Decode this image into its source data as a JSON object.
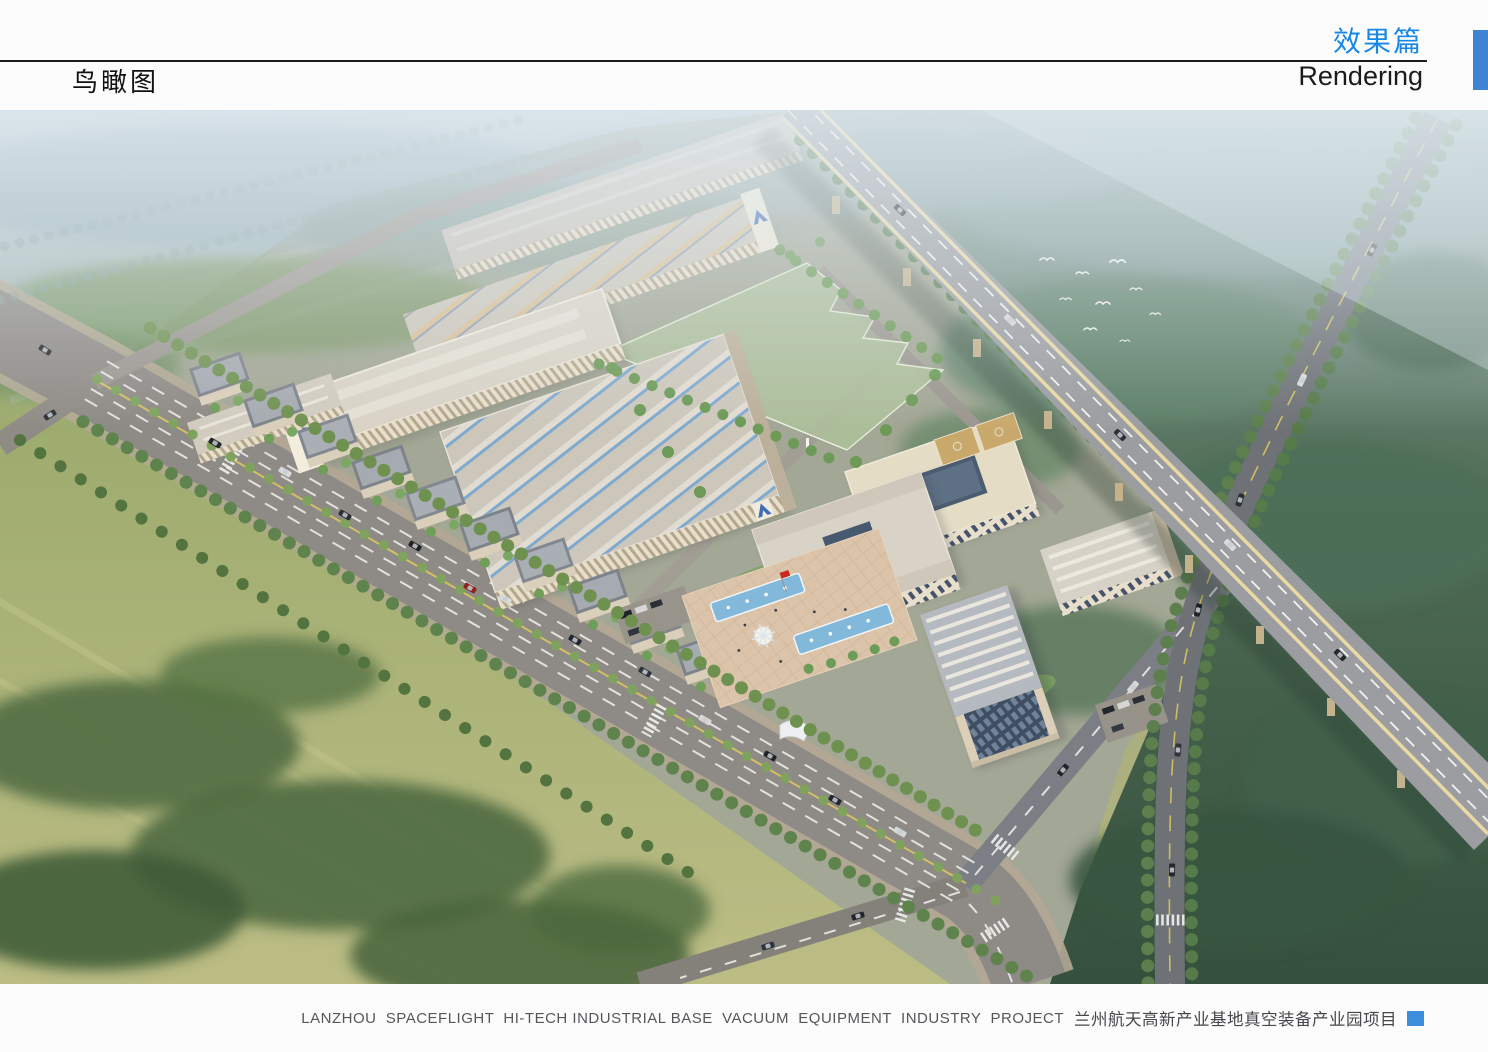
{
  "header": {
    "page_title_cn": "鸟瞰图",
    "section_title_cn": "效果篇",
    "section_title_en": "Rendering"
  },
  "footer": {
    "project_name_en": "LANZHOU  SPACEFLIGHT  HI-TECH INDUSTRIAL BASE  VACUUM  EQUIPMENT  INDUSTRY  PROJECT",
    "project_name_cn": "兰州航天高新产业基地真空装备产业园项目"
  },
  "colors": {
    "accent-blue": "#1787e9",
    "tab-blue": "#3d85d3",
    "footer-square-blue": "#3b8edc",
    "logo-blue": "#3f6cb4",
    "pool-blue": "#82b8da",
    "field-green": "#aec29b",
    "flag-red": "#cc2a1e"
  }
}
